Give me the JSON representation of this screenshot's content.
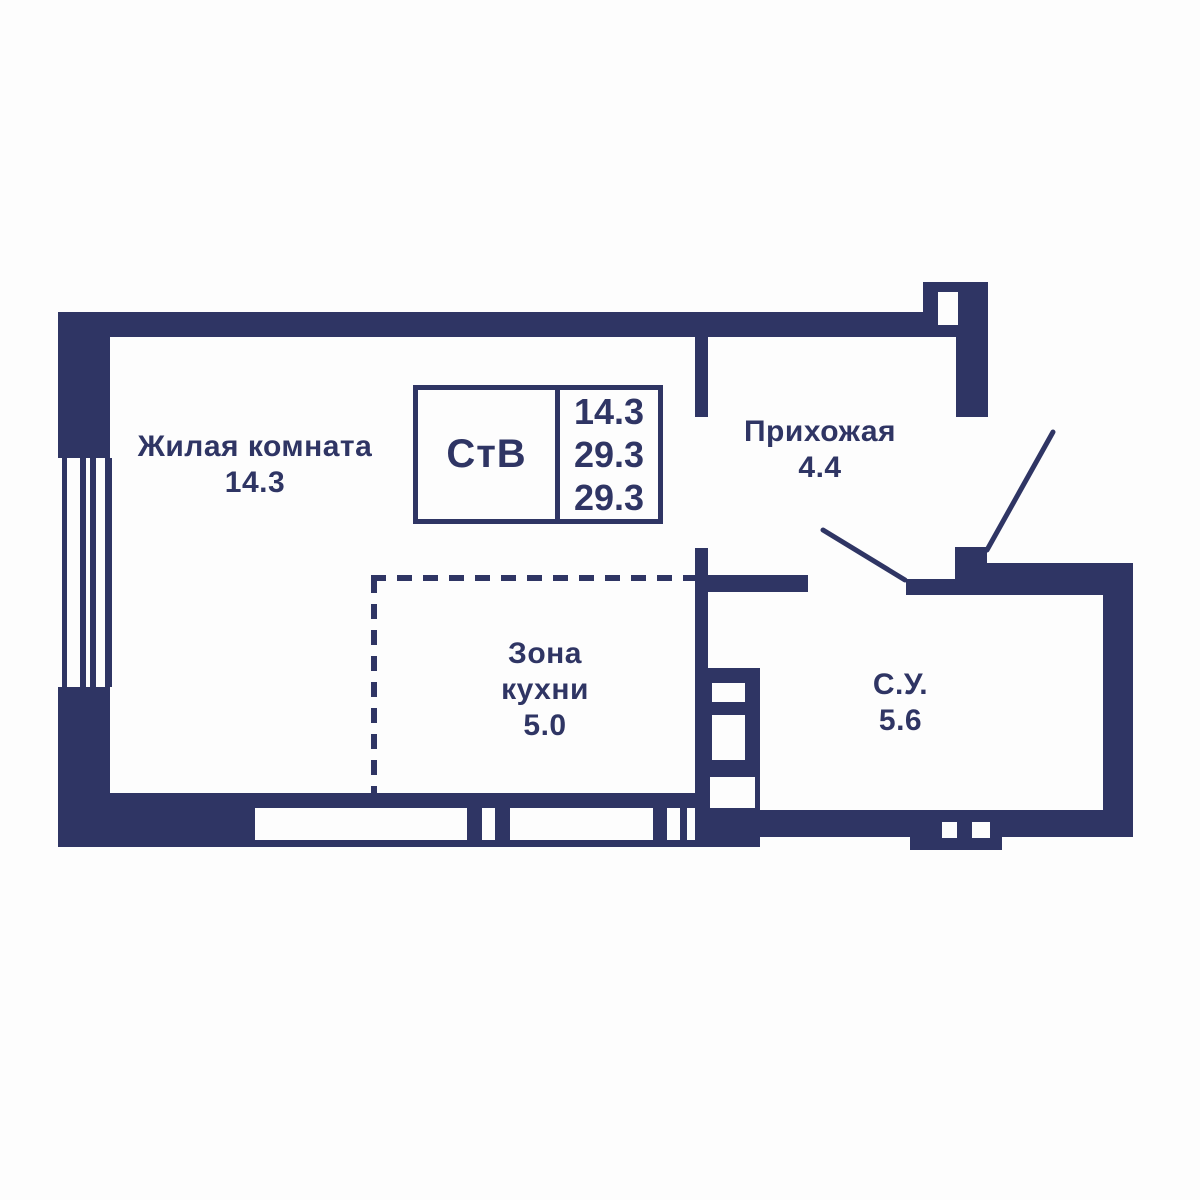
{
  "title": "Floor plan — studio apartment",
  "colors": {
    "wall": "#2f3564",
    "background": "#fdfdfd"
  },
  "info_box": {
    "type_label": "СтВ",
    "values": [
      "14.3",
      "29.3",
      "29.3"
    ]
  },
  "rooms": {
    "living": {
      "name": "Жилая комната",
      "area": "14.3"
    },
    "hallway": {
      "name": "Прихожая",
      "area": "4.4"
    },
    "kitchen": {
      "name_line1": "Зона",
      "name_line2": "кухни",
      "area": "5.0"
    },
    "bathroom": {
      "name": "С.У.",
      "area": "5.6"
    }
  }
}
